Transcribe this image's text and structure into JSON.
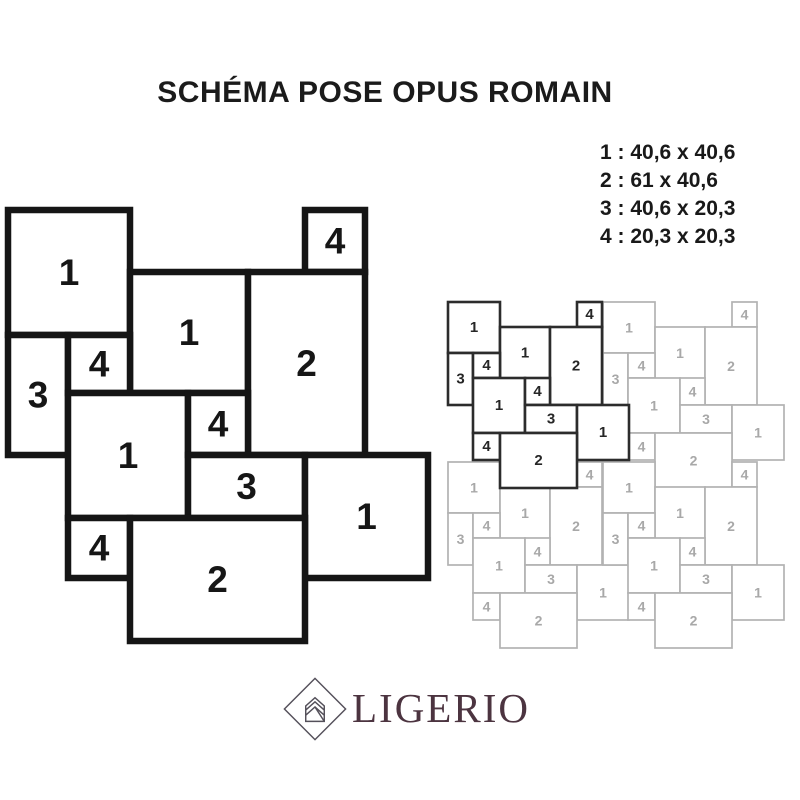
{
  "header": {
    "title": "SCHÉMA POSE OPUS ROMAIN"
  },
  "legend": {
    "items": [
      "1 : 40,6 x 40,6",
      "2 : 61 x 40,6",
      "3 : 40,6 x 20,3",
      "4 : 20,3 x 20,3"
    ]
  },
  "colors": {
    "diagram_line": "#151515",
    "diagram_text": "#161616",
    "pattern_dark_stroke": "#2c2c2c",
    "pattern_dark_text": "#262626",
    "pattern_light_stroke": "#b2b2b2",
    "pattern_light_text": "#a8a8a8",
    "tile_fill": "#ffffff",
    "logo_text_color": "#4c3440",
    "logo_icon_stroke": "#54505a"
  },
  "main_diagram": {
    "stroke_width": 6.5,
    "label_font_size": 37,
    "tiles": [
      {
        "label": "1",
        "x": 0,
        "y": 0,
        "w": 122,
        "h": 125
      },
      {
        "label": "4",
        "x": 297,
        "y": 0,
        "w": 60,
        "h": 62
      },
      {
        "label": "1",
        "x": 122,
        "y": 62,
        "w": 118,
        "h": 121
      },
      {
        "label": "2",
        "x": 240,
        "y": 62,
        "w": 117,
        "h": 183
      },
      {
        "label": "3",
        "x": 0,
        "y": 125,
        "w": 60,
        "h": 120
      },
      {
        "label": "4",
        "x": 60,
        "y": 125,
        "w": 62,
        "h": 58
      },
      {
        "label": "1",
        "x": 60,
        "y": 183,
        "w": 120,
        "h": 125
      },
      {
        "label": "4",
        "x": 180,
        "y": 183,
        "w": 60,
        "h": 62
      },
      {
        "label": "3",
        "x": 180,
        "y": 245,
        "w": 117,
        "h": 63
      },
      {
        "label": "1",
        "x": 297,
        "y": 245,
        "w": 123,
        "h": 123
      },
      {
        "label": "4",
        "x": 60,
        "y": 308,
        "w": 62,
        "h": 60
      },
      {
        "label": "2",
        "x": 122,
        "y": 308,
        "w": 175,
        "h": 123
      }
    ]
  },
  "repeat_pattern": {
    "dark_stroke_width": 2.6,
    "light_stroke_width": 1.7,
    "dark_label_font_size": 15,
    "light_label_font_size": 14,
    "module_tiles": [
      {
        "label": "1",
        "x": 0,
        "y": 0,
        "w": 52,
        "h": 51
      },
      {
        "label": "4",
        "x": 129,
        "y": 0,
        "w": 25,
        "h": 25
      },
      {
        "label": "1",
        "x": 52,
        "y": 25,
        "w": 50,
        "h": 52
      },
      {
        "label": "2",
        "x": 102,
        "y": 25,
        "w": 52,
        "h": 78
      },
      {
        "label": "3",
        "x": 0,
        "y": 51,
        "w": 25,
        "h": 52
      },
      {
        "label": "4",
        "x": 25,
        "y": 51,
        "w": 27,
        "h": 25
      },
      {
        "label": "1",
        "x": 25,
        "y": 76,
        "w": 52,
        "h": 55
      },
      {
        "label": "4",
        "x": 77,
        "y": 76,
        "w": 25,
        "h": 27
      },
      {
        "label": "3",
        "x": 77,
        "y": 103,
        "w": 52,
        "h": 28
      },
      {
        "label": "1",
        "x": 129,
        "y": 103,
        "w": 52,
        "h": 55
      },
      {
        "label": "4",
        "x": 25,
        "y": 131,
        "w": 27,
        "h": 27
      },
      {
        "label": "2",
        "x": 52,
        "y": 131,
        "w": 77,
        "h": 55
      }
    ],
    "instances": [
      {
        "dx": 0,
        "dy": 0,
        "variant": "dark"
      },
      {
        "dx": 155,
        "dy": 0,
        "variant": "light"
      },
      {
        "dx": 0,
        "dy": 160,
        "variant": "light"
      },
      {
        "dx": 155,
        "dy": 160,
        "variant": "light"
      }
    ]
  },
  "logo": {
    "text": "LIGERIO"
  }
}
